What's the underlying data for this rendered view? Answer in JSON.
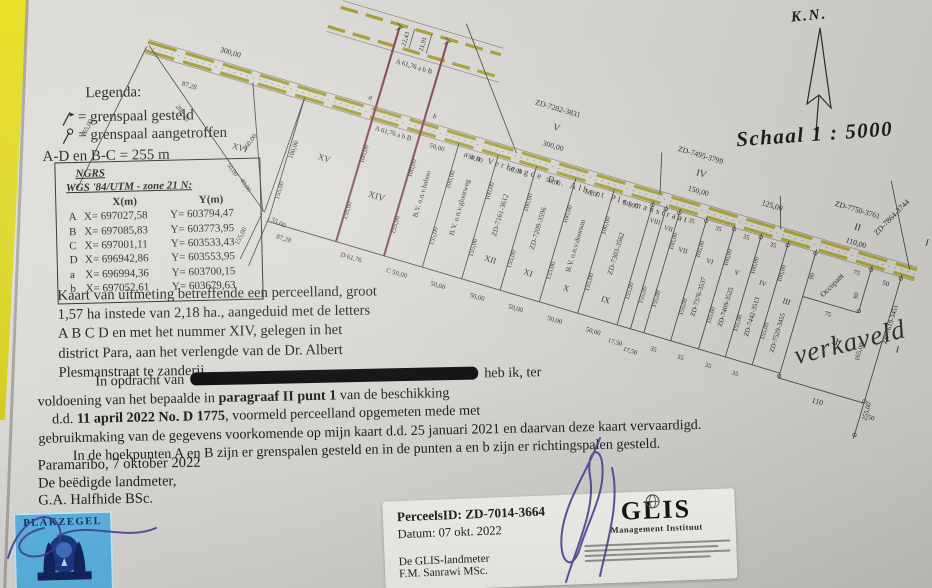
{
  "doc": {
    "legend": {
      "title": "Legenda:",
      "item1": "= grenspaal gesteld",
      "item2": "= grenspaal aangetroffen",
      "note": "A-D en B-C = 255 m"
    },
    "ngrs": {
      "title": "NGRS",
      "subtitle": "WGS '84/UTM - zone 21 N:",
      "colx": "X(m)",
      "coly": "Y(m)",
      "rows": [
        {
          "p": "A",
          "x": "X= 697027,58",
          "y": "Y= 603794,47"
        },
        {
          "p": "B",
          "x": "X= 697085,83",
          "y": "Y= 603773,95"
        },
        {
          "p": "C",
          "x": "X= 697001,11",
          "y": "Y= 603533,43"
        },
        {
          "p": "D",
          "x": "X= 696942,86",
          "y": "Y= 603553,95"
        },
        {
          "p": "a",
          "x": "X= 696994,36",
          "y": "Y= 603700,15"
        },
        {
          "p": "b",
          "x": "X= 697052,61",
          "y": "Y= 603679,63"
        }
      ]
    },
    "para1": {
      "l1": "Kaart van uitmeting betreffende een perceelland, groot",
      "l2": "1,57 ha instede van 2,18 ha., aangeduid met de letters",
      "l3": "A B C D en met het nummer XIV, gelegen in het",
      "l4": "district Para, aan het verlengde van de Dr. Albert",
      "l5": "Plesmanstraat te zanderij."
    },
    "para2": {
      "opdracht": "In opdracht van",
      "heb": "heb ik, ter",
      "l2a": "voldoening van  het bepaalde in",
      "l2b": "paragraaf II punt 1",
      "l2c": "van de beschikking",
      "l3a": "d.d.",
      "l3b": "11 april 2022 No. D 1775",
      "l3c": ", voormeld perceelland opgemeten mede met",
      "l4": "gebruikmaking van de gegevens voorkomende op mijn kaart d.d. 25 januari 2021 en daarvan deze kaart vervaardigd.",
      "l5": "In de hoekpunten A en B zijn er grenspalen gesteld en in de punten a en b zijn er richtingspalen gesteld."
    },
    "signoff": {
      "place": "Paramaribo, 7 oktober 2022",
      "role": "De beëdigde landmeter,",
      "name": "G.A. Halfhide BSc."
    },
    "plakzegel": "PLAKZEGEL",
    "glis": {
      "perceel": "PerceelsID: ZD-7014-3664",
      "datum": "Datum: 07 okt. 2022",
      "role": "De GLIS-landmeter",
      "name": "F.M. Sanrawi MSc.",
      "logo": "GLIS",
      "logo_sub": "Management Instituut"
    }
  },
  "map": {
    "kn": "K.N.",
    "scale": "Schaal 1 : 5000",
    "verkaveld": "verkaveld",
    "road_name": "aan Verlengde Dr. Albert Plesmanstraat",
    "north": {
      "zd_v": "ZD-7282-3831",
      "v": "V",
      "d300": "300,00",
      "zd_iv": "ZD-7495-3799",
      "iv": "IV",
      "d150": "150,00",
      "d125": "125,00",
      "zd_ii": "ZD-7750-3761",
      "ii": "II",
      "d110": "110,00",
      "zd_i": "ZD-7864-3744",
      "i": "I"
    },
    "strips": {
      "xiv": "XIV",
      "xv": "XV",
      "xvi": "XVI",
      "ab_label": "A 61,76 a b B",
      "a": "a",
      "b": "b",
      "baboo": "B.V. o.n.v.baboo",
      "gloorweg": "B.V. o.n.v.gloorweg",
      "doorson": "B.V. o.n.v.doorson",
      "zd_xii": "ZD-7161-3612",
      "xii": "XII",
      "zd_xi": "ZD-7209-3596",
      "xi": "XI",
      "x": "X",
      "zd_ix": "ZD-7303-3562",
      "ix": "IX",
      "viii": "VIII",
      "vii": "VII",
      "zd_vi": "ZD-7376-3537",
      "vi": "VI",
      "zd_v": "ZD-7409-3525",
      "v": "V",
      "zd_iv": "ZD-7442-3513",
      "iv": "IV",
      "zd_iii": "ZD-7529-3455",
      "iii": "III",
      "ii": "II",
      "i": "I",
      "occupant": "Occupant",
      "zd_side": "ZD-7619-3451"
    },
    "dims": {
      "w50": "50,00",
      "w35": "35",
      "w175": "17,50",
      "d100": "100,00",
      "d155": "155,00",
      "d165": "165,00",
      "d255": "255,00",
      "d110": "110",
      "d50": "50",
      "d75": "75",
      "d90": "90",
      "w8728": "87,28",
      "d20835": "208,35",
      "d160": "160,00",
      "d55": "55,00",
      "d40": "40,00",
      "w2243": "22,43",
      "w2191": "21,91",
      "cd": "D 61,76",
      "cc": "C 50,00"
    }
  }
}
